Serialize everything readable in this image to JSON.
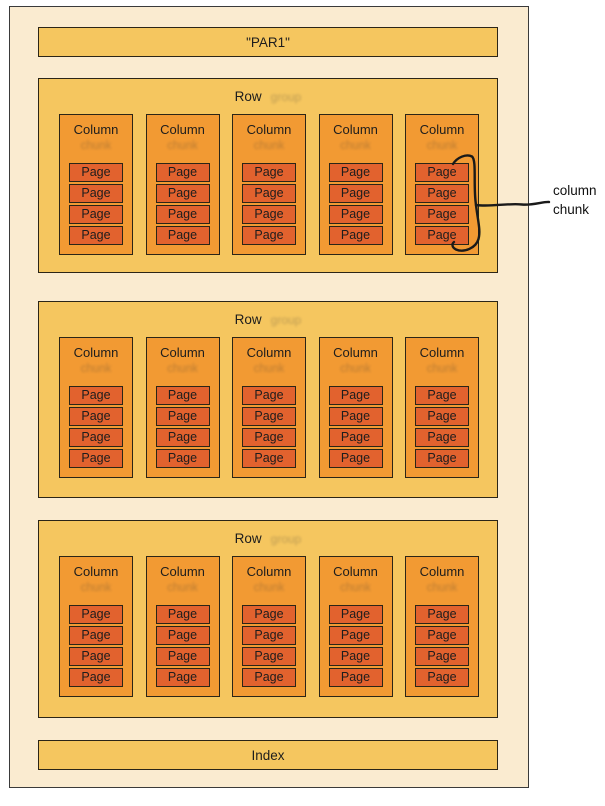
{
  "annotation": {
    "line1": "column",
    "line2": "chunk"
  },
  "colors": {
    "file_bg": "#faebd0",
    "bar_bg": "#f5c65f",
    "column_bg": "#f29a33",
    "page_bg": "#e2622e",
    "box_border": "#2b2517",
    "outer_border": "#3a3a3a",
    "hand_stroke": "#1a1a1a"
  },
  "file": {
    "header_label": "\"PAR1\"",
    "index_label": "Index",
    "row_groups": [
      {
        "label": "Row",
        "erased_remnant": "group",
        "columns": [
          {
            "label": "Column",
            "erased_remnant": "chunk",
            "pages": [
              "Page",
              "Page",
              "Page",
              "Page"
            ]
          },
          {
            "label": "Column",
            "erased_remnant": "chunk",
            "pages": [
              "Page",
              "Page",
              "Page",
              "Page"
            ]
          },
          {
            "label": "Column",
            "erased_remnant": "chunk",
            "pages": [
              "Page",
              "Page",
              "Page",
              "Page"
            ]
          },
          {
            "label": "Column",
            "erased_remnant": "chunk",
            "pages": [
              "Page",
              "Page",
              "Page",
              "Page"
            ]
          },
          {
            "label": "Column",
            "erased_remnant": "chunk",
            "pages": [
              "Page",
              "Page",
              "Page",
              "Page"
            ]
          }
        ]
      },
      {
        "label": "Row",
        "erased_remnant": "group",
        "columns": [
          {
            "label": "Column",
            "erased_remnant": "chunk",
            "pages": [
              "Page",
              "Page",
              "Page",
              "Page"
            ]
          },
          {
            "label": "Column",
            "erased_remnant": "chunk",
            "pages": [
              "Page",
              "Page",
              "Page",
              "Page"
            ]
          },
          {
            "label": "Column",
            "erased_remnant": "chunk",
            "pages": [
              "Page",
              "Page",
              "Page",
              "Page"
            ]
          },
          {
            "label": "Column",
            "erased_remnant": "chunk",
            "pages": [
              "Page",
              "Page",
              "Page",
              "Page"
            ]
          },
          {
            "label": "Column",
            "erased_remnant": "chunk",
            "pages": [
              "Page",
              "Page",
              "Page",
              "Page"
            ]
          }
        ]
      },
      {
        "label": "Row",
        "erased_remnant": "group",
        "columns": [
          {
            "label": "Column",
            "erased_remnant": "chunk",
            "pages": [
              "Page",
              "Page",
              "Page",
              "Page"
            ]
          },
          {
            "label": "Column",
            "erased_remnant": "chunk",
            "pages": [
              "Page",
              "Page",
              "Page",
              "Page"
            ]
          },
          {
            "label": "Column",
            "erased_remnant": "chunk",
            "pages": [
              "Page",
              "Page",
              "Page",
              "Page"
            ]
          },
          {
            "label": "Column",
            "erased_remnant": "chunk",
            "pages": [
              "Page",
              "Page",
              "Page",
              "Page"
            ]
          },
          {
            "label": "Column",
            "erased_remnant": "chunk",
            "pages": [
              "Page",
              "Page",
              "Page",
              "Page"
            ]
          }
        ]
      }
    ]
  }
}
